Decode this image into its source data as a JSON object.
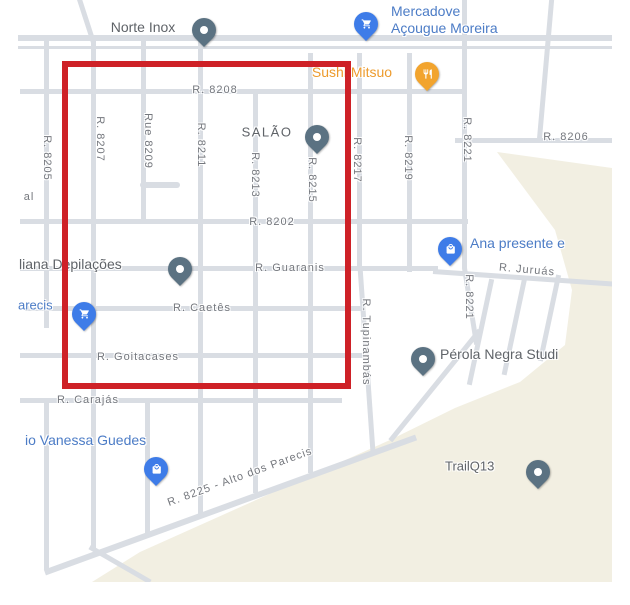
{
  "colors": {
    "map-bg": "#ffffff",
    "road": "#d9dde3",
    "terrain": "#f2efe2",
    "annotation-red": "#ce2127",
    "street-label": "#74777d",
    "poi-gray": "#5f6368",
    "poi-blue": "#4c7cc6",
    "poi-orange": "#ed9b2d",
    "pin-slate": "#5b7282",
    "pin-blue": "#3e7ce8",
    "pin-orange": "#f2a42e"
  },
  "annotation": {
    "shape": "rectangle",
    "color": "#ce2127"
  },
  "streets": [
    {
      "name": "R. 8208"
    },
    {
      "name": "R. 8205"
    },
    {
      "name": "R. 8207"
    },
    {
      "name": "Rue 8209"
    },
    {
      "name": "R. 8211"
    },
    {
      "name": "R. 8213"
    },
    {
      "name": "R. 8215"
    },
    {
      "name": "R. 8217"
    },
    {
      "name": "R. 8219"
    },
    {
      "name": "R. 8221"
    },
    {
      "name": "R. 8206"
    },
    {
      "name": "R. 8202"
    },
    {
      "name": "R. Guaranis"
    },
    {
      "name": "R. Juruás"
    },
    {
      "name": "R. 8221"
    },
    {
      "name": "R. Caetês"
    },
    {
      "name": "R. Tupinambás"
    },
    {
      "name": "R. Goitacases"
    },
    {
      "name": "R. Carajás"
    },
    {
      "name": "R. 8225 - Alto dos Parecis"
    },
    {
      "name": "al"
    }
  ],
  "pois": {
    "norte_inox": {
      "name": "Norte Inox"
    },
    "mercadove": {
      "name": "Mercadove\nAçougue Moreira"
    },
    "sushi_mitsuo": {
      "name": "Sushi Mitsuo"
    },
    "salao": {
      "name": "SALÃO"
    },
    "ana_presente": {
      "name": "Ana presente e"
    },
    "depilacoes": {
      "name": "liana Depilações"
    },
    "parecis": {
      "name": "arecis"
    },
    "perola_negra": {
      "name": "Pérola Negra Studi"
    },
    "vanessa_guedes": {
      "name": "io Vanessa Guedes"
    },
    "trailq13": {
      "name": "TrailQ13"
    }
  }
}
